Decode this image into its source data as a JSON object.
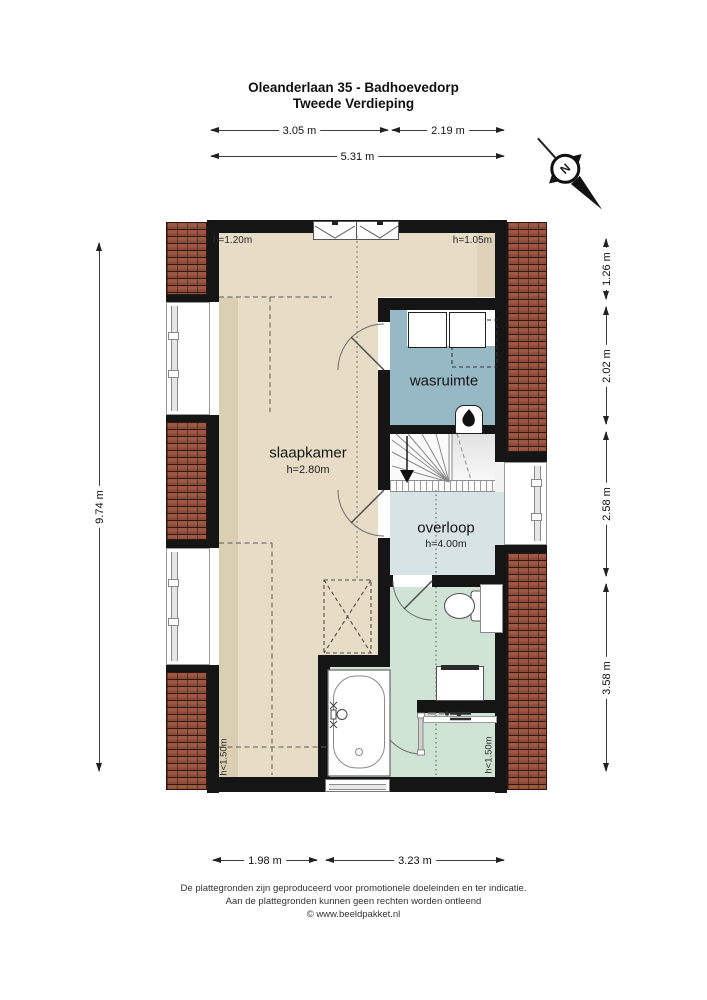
{
  "header": {
    "title_line1": "Oleanderlaan 35 - Badhoevedorp",
    "title_line2": "Tweede Verdieping"
  },
  "compass": {
    "label": "N",
    "icon": "north-arrow-icon"
  },
  "dimensions": {
    "top": [
      {
        "label": "3.05 m"
      },
      {
        "label": "2.19 m"
      },
      {
        "label": "5.31 m"
      }
    ],
    "left": [
      {
        "label": "9.74 m"
      }
    ],
    "right": [
      {
        "label": "1.26 m"
      },
      {
        "label": "2.02 m"
      },
      {
        "label": "2.58 m"
      },
      {
        "label": "3.58 m"
      }
    ],
    "bottom": [
      {
        "label": "1.98 m"
      },
      {
        "label": "3.23 m"
      }
    ]
  },
  "rooms": {
    "slaapkamer": {
      "name": "slaapkamer",
      "height": "h=2.80m"
    },
    "wasruimte": {
      "name": "wasruimte"
    },
    "overloop": {
      "name": "overloop",
      "height": "h=4.00m"
    }
  },
  "height_annotations": {
    "top_left": "h=1.20m",
    "top_right": "h=1.05m",
    "bottom_left": "h<1.50m",
    "bottom_right": "h<1.50m"
  },
  "footer": {
    "line1": "De plattegronden zijn geproduceerd voor promotionele doeleinden en ter indicatie.",
    "line2": "Aan de plattegronden kunnen geen rechten worden ontleend",
    "line3": "© www.beeldpakket.nl"
  },
  "icons": {
    "washer": "washing-machine-icon",
    "dryer": "dryer-icon",
    "heater": "heater-flame-icon",
    "toilet": "toilet-icon",
    "sink": "sink-icon",
    "shower": "shower-icon",
    "bathtub": "bathtub-icon",
    "stairs": "staircase-icon",
    "skylight": "skylight-icon"
  },
  "colors": {
    "wall": "#151515",
    "slaapkamer_floor": "#e7ddc7",
    "slaapkamer_low_zone": "#dbcfb3",
    "wasruimte_floor": "#97b9c5",
    "overloop_floor": "#d7e3e4",
    "badkamer_floor": "#cfe4d5",
    "brick": "#9c5844"
  }
}
